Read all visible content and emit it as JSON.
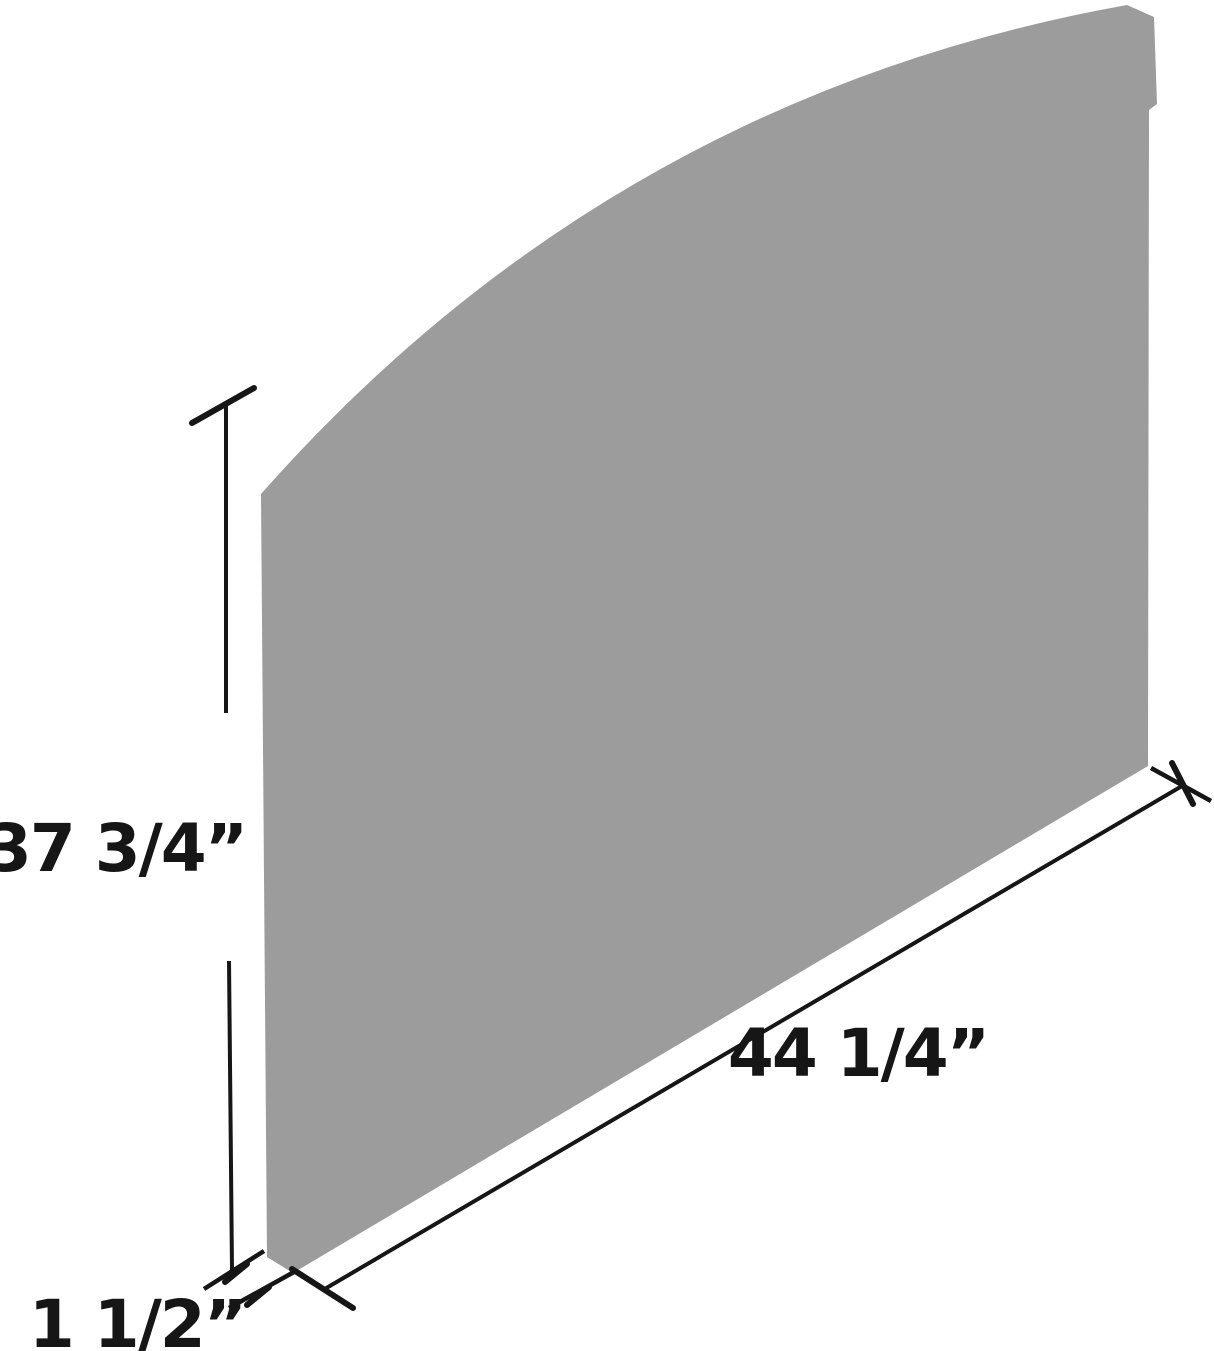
{
  "diagram": {
    "kind": "product-dimension-diagram",
    "background_color": "#ffffff",
    "panel_color": "#9c9c9c",
    "line_color": "#161616",
    "dimensions": {
      "height": "37 3/4”",
      "length": "44 1/4”",
      "thickness": "1 1/2”"
    }
  }
}
